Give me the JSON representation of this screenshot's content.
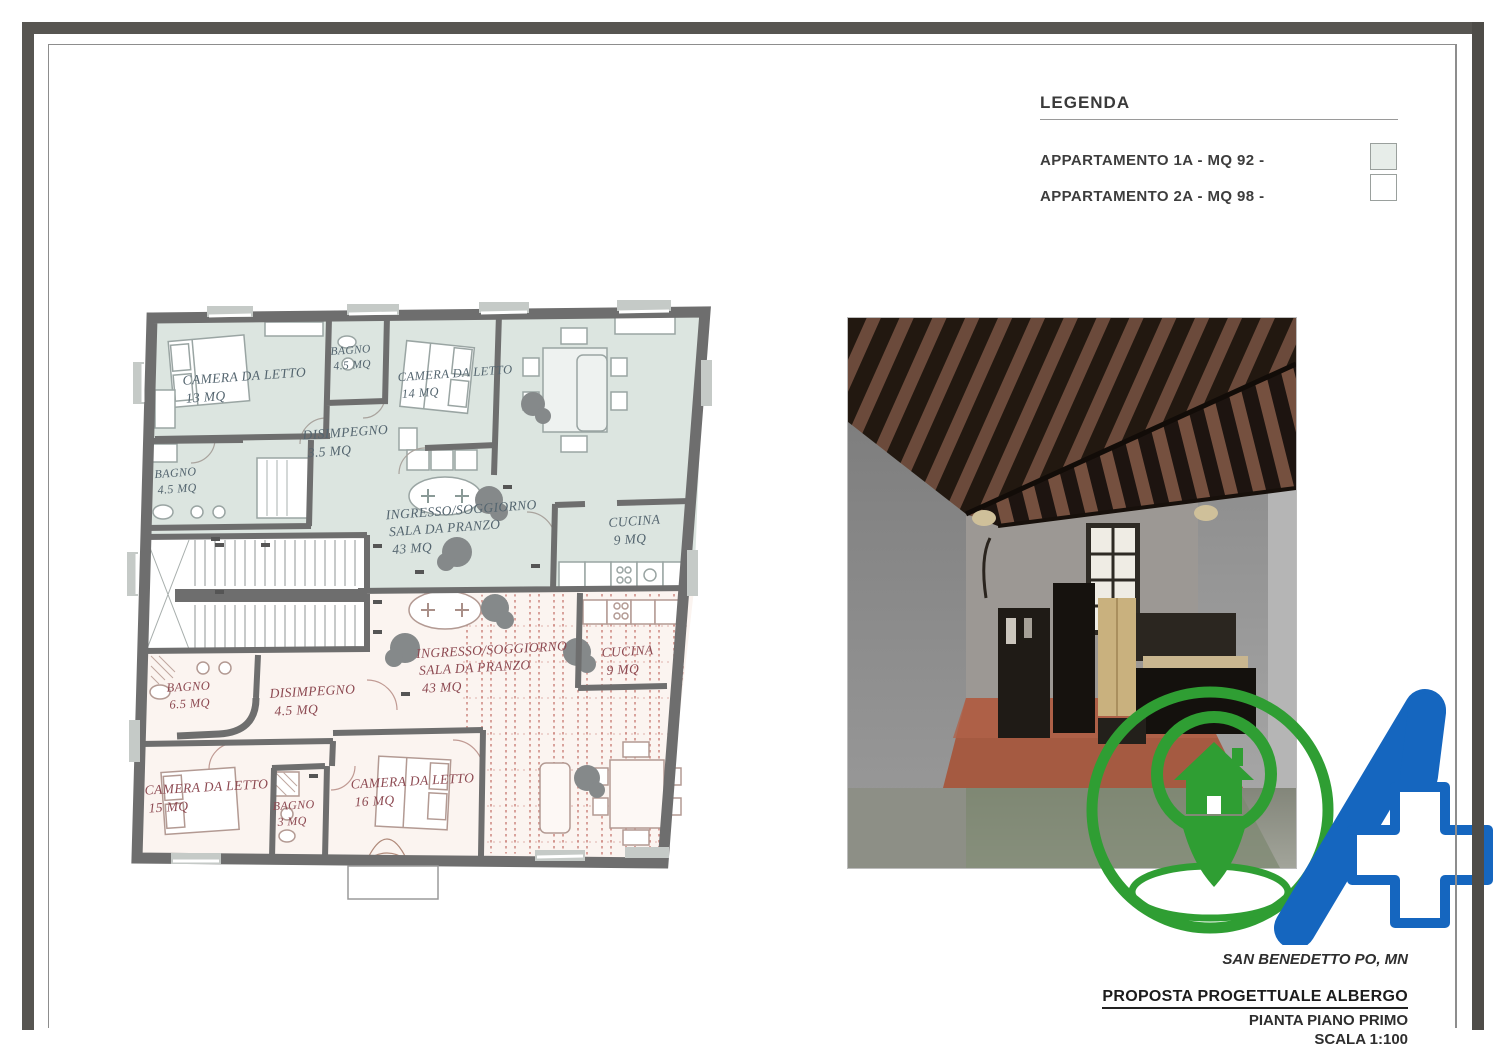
{
  "legend": {
    "title": "LEGENDA",
    "items": [
      {
        "label": "APPARTAMENTO 1A - MQ 92 -"
      },
      {
        "label": "APPARTAMENTO 2A - MQ 98 -"
      }
    ]
  },
  "title_block": {
    "location": "SAN BENEDETTO PO, MN",
    "project": "PROPOSTA PROGETTUALE ALBERGO",
    "drawing": "PIANTA PIANO PRIMO",
    "scale": "SCALA 1:100"
  },
  "floor_plan": {
    "apartment_1a": {
      "camera13": {
        "name": "CAMERA DA LETTO",
        "area": "13 MQ"
      },
      "bagno_top": {
        "name": "BAGNO",
        "area": "4.5 MQ"
      },
      "camera14": {
        "name": "CAMERA DA LETTO",
        "area": "14 MQ"
      },
      "disimpegno": {
        "name": "DISIMPEGNO",
        "area": "3.5 MQ"
      },
      "bagno_left": {
        "name": "BAGNO",
        "area": "4.5 MQ"
      },
      "soggiorno": {
        "name1": "INGRESSO/SOGGIORNO",
        "name2": "SALA DA PRANZO",
        "area": "43 MQ"
      },
      "cucina": {
        "name": "CUCINA",
        "area": "9 MQ"
      }
    },
    "apartment_2a": {
      "bagno": {
        "name": "BAGNO",
        "area": "6.5 MQ"
      },
      "disimpegno": {
        "name": "DISIMPEGNO",
        "area": "4.5 MQ"
      },
      "soggiorno": {
        "name1": "INGRESSO/SOGGIORNO",
        "name2": "SALA DA PRANZO",
        "area": "43 MQ"
      },
      "cucina": {
        "name": "CUCINA",
        "area": "9 MQ"
      },
      "camera15": {
        "name": "CAMERA DA LETTO",
        "area": "15 MQ"
      },
      "bagno_small": {
        "name": "BAGNO",
        "area": "3 MQ"
      },
      "camera16": {
        "name": "CAMERA DA LETTO",
        "area": "16 MQ"
      }
    }
  },
  "colors": {
    "apartment_1a_fill": "#dde6e1",
    "apartment_2a_fill": "#fbf5f1",
    "hatch_red": "#bc6058",
    "wall_gray": "#6e6e6e",
    "label_1a": "#54656f",
    "label_2a": "#8d4a52",
    "legend_swatch_1a": "#e7ede9",
    "legend_swatch_2a": "#ffffff",
    "logo_green": "#2f9e33",
    "logo_blue": "#1566bf"
  }
}
